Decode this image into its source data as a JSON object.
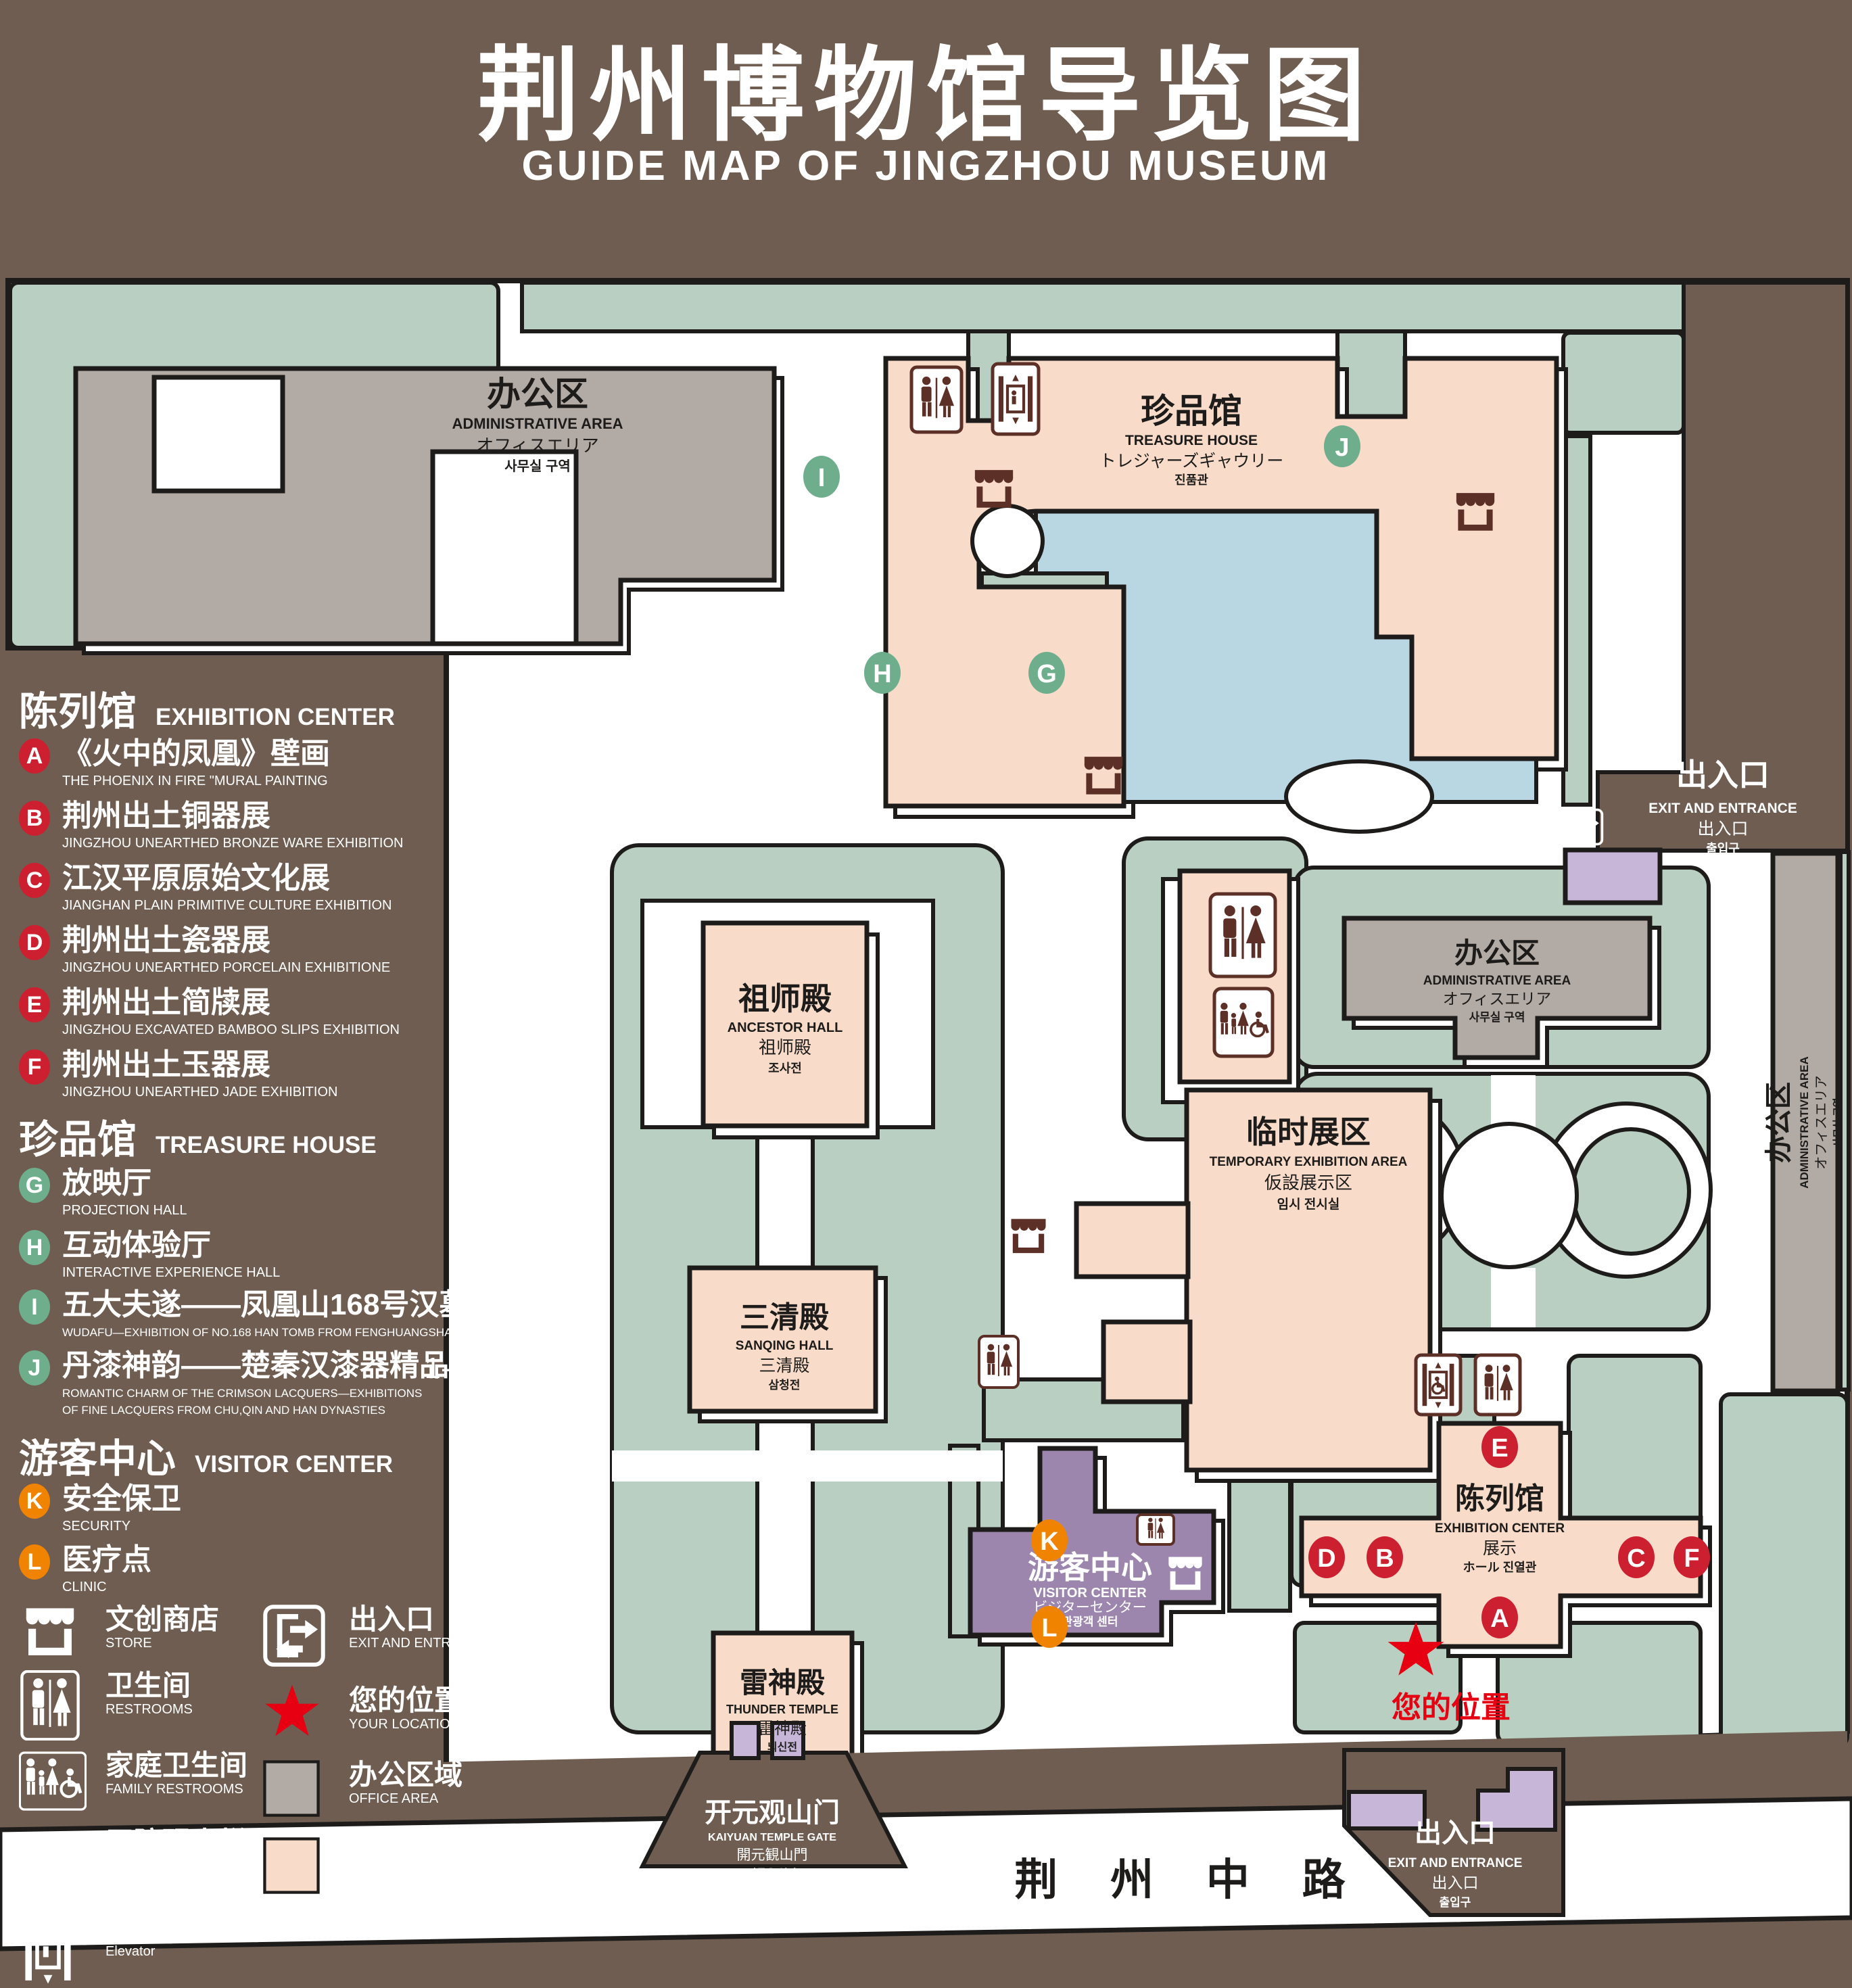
{
  "title": {
    "cn": "荆州博物馆导览图",
    "en": "GUIDE MAP OF JINGZHOU MUSEUM"
  },
  "legend": {
    "sections": [
      {
        "cn": "陈列馆",
        "en": "EXHIBITION CENTER",
        "items": [
          {
            "key": "A",
            "cn": "《火中的凤凰》壁画",
            "en": "THE PHOENIX IN FIRE \"MURAL PAINTING",
            "floor": "1F"
          },
          {
            "key": "B",
            "cn": "荆州出土铜器展",
            "en": "JINGZHOU UNEARTHED BRONZE WARE EXHIBITION",
            "floor": "1F"
          },
          {
            "key": "C",
            "cn": "江汉平原原始文化展",
            "en": "JIANGHAN PLAIN PRIMITIVE CULTURE EXHIBITION",
            "floor": "1F"
          },
          {
            "key": "D",
            "cn": "荆州出土瓷器展",
            "en": "JINGZHOU UNEARTHED PORCELAIN EXHIBITIONE",
            "floor": "2F"
          },
          {
            "key": "E",
            "cn": "荆州出土简牍展",
            "en": "JINGZHOU EXCAVATED BAMBOO SLIPS EXHIBITION",
            "floor": "2F"
          },
          {
            "key": "F",
            "cn": "荆州出土玉器展",
            "en": "JINGZHOU UNEARTHED JADE EXHIBITION",
            "floor": "2F"
          }
        ]
      },
      {
        "cn": "珍品馆",
        "en": "TREASURE HOUSE",
        "items": [
          {
            "key": "G",
            "cn": "放映厅",
            "en": "PROJECTION HALL",
            "floor": "1F"
          },
          {
            "key": "H",
            "cn": "互动体验厅",
            "en": "INTERACTIVE EXPERIENCE HALL",
            "floor": "1F"
          },
          {
            "key": "I",
            "cn": "五大夫遂——凤凰山168号汉墓展",
            "en": "WUDAFU—EXHIBITION OF NO.168 HAN TOMB FROM FENGHUANGSHAN",
            "floor": "2F"
          },
          {
            "key": "J",
            "cn": "丹漆神韵——楚秦汉漆器精品展",
            "en": "ROMANTIC CHARM OF THE CRIMSON LACQUERS—EXHIBITIONS\nOF FINE LACQUERS FROM CHU,QIN AND HAN DYNASTIES",
            "floor": "1-2F"
          }
        ]
      },
      {
        "cn": "游客中心",
        "en": "VISITOR CENTER",
        "items": [
          {
            "key": "K",
            "cn": "安全保卫",
            "en": "SECURITY",
            "floor": "1F"
          },
          {
            "key": "L",
            "cn": "医疗点",
            "en": "CLINIC",
            "floor": "1F"
          }
        ]
      }
    ],
    "symbols": [
      {
        "cn": "文创商店",
        "en": "STORE",
        "icon": "store-icon"
      },
      {
        "cn": "卫生间",
        "en": "RESTROOMS",
        "icon": "restrooms-icon"
      },
      {
        "cn": "家庭卫生间",
        "en": "FAMILY RESTROOMS",
        "icon": "family-restrooms-icon"
      },
      {
        "cn": "无障碍电梯",
        "en": "ACCESSIBLE ELEVATOR",
        "icon": "accessible-elevator-icon"
      },
      {
        "cn": "电梯",
        "en": "Elevator",
        "icon": "elevator-icon"
      },
      {
        "cn": "出入口",
        "en": "EXIT AND ENTRANCE",
        "icon": "exit-entrance-icon"
      },
      {
        "cn": "您的位置",
        "en": "YOUR LOCATION",
        "icon": "your-location-star-icon"
      },
      {
        "cn": "办公区域",
        "en": "OFFICE AREA",
        "icon": "office-area-swatch"
      },
      {
        "cn": "展示区域",
        "en": "DISPLAY AREA",
        "icon": "display-area-swatch"
      }
    ]
  },
  "map": {
    "admin_tl": {
      "cn": "办公区",
      "en": "ADMINISTRATIVE AREA",
      "jp": "オフィスエリア",
      "kr": "사무실 구역"
    },
    "treasure": {
      "cn": "珍品馆",
      "en": "TREASURE HOUSE",
      "jp": "トレジャーズギャウリー",
      "kr": "진품관"
    },
    "ancestor": {
      "cn": "祖师殿",
      "en": "ANCESTOR HALL",
      "jp": "祖师殿",
      "kr": "조사전"
    },
    "temporary": {
      "cn": "临时展区",
      "en": "TEMPORARY EXHIBITION AREA",
      "jp": "仮設展示区",
      "kr": "임시 전시실"
    },
    "admin_r": {
      "cn": "办公区",
      "en": "ADMINISTRATIVE AREA",
      "jp": "オフィスエリア",
      "kr": "사무실 구역"
    },
    "admin_strip": {
      "cn": "办公区",
      "en": "ADMINISTRATIVE AREA",
      "jp": "オフィスエリア",
      "kr": "사무실 구역"
    },
    "sanqing": {
      "cn": "三清殿",
      "en": "SANQING HALL",
      "jp": "三清殿",
      "kr": "삼청전"
    },
    "thunder": {
      "cn": "雷神殿",
      "en": "THUNDER TEMPLE",
      "jp": "雷神殿",
      "kr": "뇌신전"
    },
    "visitor": {
      "cn": "游客中心",
      "en": "VISITOR CENTER",
      "jp": "ビジターセンター",
      "kr": "관광객 센터"
    },
    "exhibition": {
      "cn": "陈列馆",
      "en": "EXHIBITION CENTER",
      "jp": "展示",
      "kr": "ホール 진열관"
    },
    "exit_tr": {
      "cn": "出入口",
      "en": "EXIT AND ENTRANCE",
      "jp": "出入口",
      "kr": "출입구"
    },
    "exit_b": {
      "cn": "出入口",
      "en": "EXIT AND ENTRANCE",
      "jp": "出入口",
      "kr": "출입구"
    },
    "gate": {
      "cn": "开元观山门",
      "en": "KAIYUAN TEMPLE GATE",
      "jp": "開元観山門",
      "kr": "산문을 열다"
    },
    "road": "荆 州 中 路",
    "your_location": "您的位置"
  },
  "markers": [
    {
      "letter": "A"
    },
    {
      "letter": "B"
    },
    {
      "letter": "C"
    },
    {
      "letter": "D"
    },
    {
      "letter": "E"
    },
    {
      "letter": "F"
    },
    {
      "letter": "G"
    },
    {
      "letter": "H"
    },
    {
      "letter": "I"
    },
    {
      "letter": "J"
    },
    {
      "letter": "K"
    },
    {
      "letter": "L"
    }
  ],
  "colors": {
    "background": "#6e5d50",
    "lawn": "#b8cfc1",
    "display_area": "#f8dcc9",
    "office_area": "#b2aaa4",
    "visitor_purple": "#9c86ae",
    "light_purple": "#c7b6d8",
    "pond_blue": "#b9d7e3",
    "icon_brown": "#5d3027",
    "marker_red": "#cc2030",
    "marker_green": "#6fae8c",
    "marker_orange": "#f08300",
    "star_red": "#e60012",
    "outline": "#1d1c1a"
  }
}
